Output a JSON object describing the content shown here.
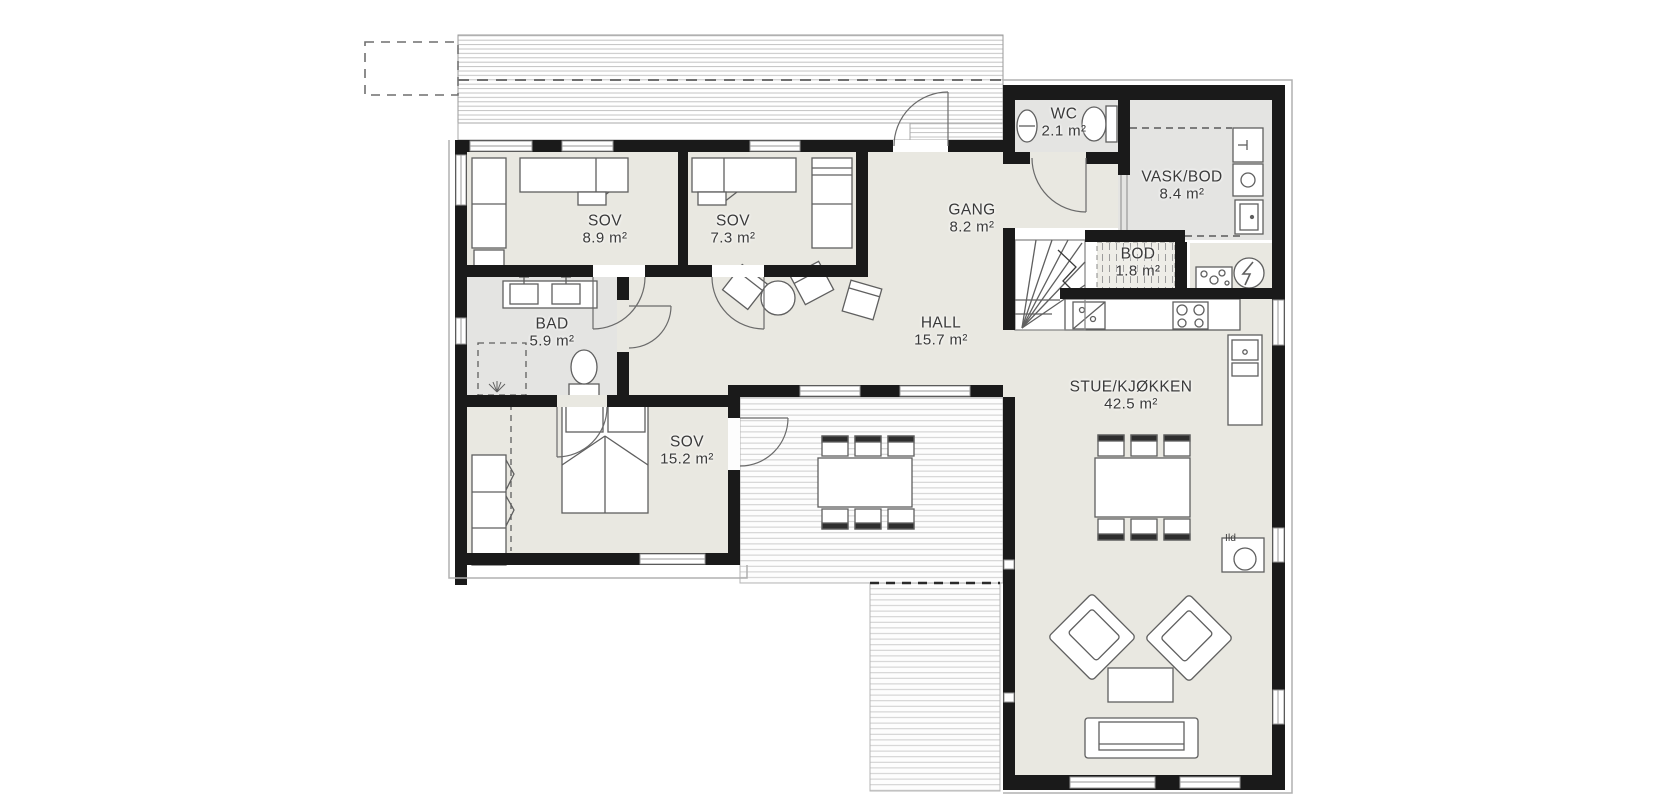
{
  "rooms": {
    "sov1": {
      "name": "SOV",
      "area": "8.9 m²"
    },
    "sov2": {
      "name": "SOV",
      "area": "7.3 m²"
    },
    "gang": {
      "name": "GANG",
      "area": "8.2 m²"
    },
    "wc": {
      "name": "WC",
      "area": "2.1 m²"
    },
    "vaskbod": {
      "name": "VASK/BOD",
      "area": "8.4 m²"
    },
    "bod": {
      "name": "BOD",
      "area": "1.8 m²"
    },
    "bad": {
      "name": "BAD",
      "area": "5.9 m²"
    },
    "hall": {
      "name": "HALL",
      "area": "15.7 m²"
    },
    "sov3": {
      "name": "SOV",
      "area": "15.2 m²"
    },
    "stue": {
      "name": "STUE/KJØKKEN",
      "area": "42.5 m²"
    }
  },
  "annotations": {
    "fireplace_label": "Ild"
  },
  "colors": {
    "wall": "#1a1a1a",
    "floor": "#e9e8e1",
    "wet_floor": "#e4e4e2",
    "furniture_line": "#5f5f5f",
    "deck_line": "#cdcdcd"
  }
}
